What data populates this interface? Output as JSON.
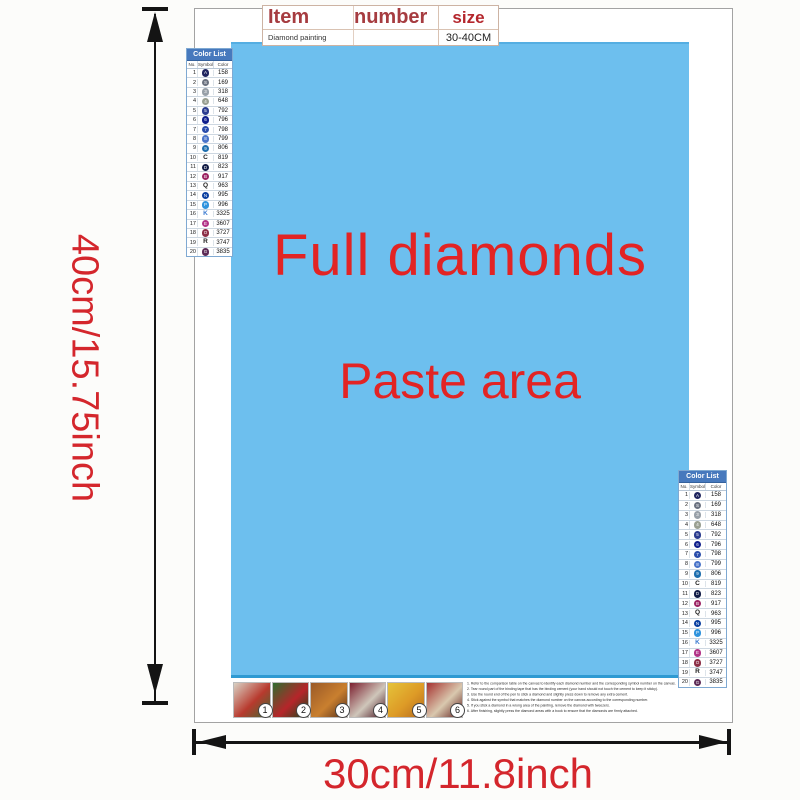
{
  "item_table": {
    "headers": [
      "Item",
      "number",
      "size"
    ],
    "product": "Diamond painting",
    "number_value": "",
    "size": "30-40CM"
  },
  "paste": {
    "line1": "Full diamonds",
    "line2": "Paste area",
    "bg_color": "#6dbfee",
    "text_color": "#e22424"
  },
  "dims": {
    "height": "40cm/15.75inch",
    "width": "30cm/11.8inch"
  },
  "color_list": {
    "title": "Color List",
    "columns": [
      "No.",
      "Symbol",
      "Color"
    ],
    "rows": [
      {
        "no": "1",
        "symbol": "A",
        "circle": "#20255f",
        "code": "158"
      },
      {
        "no": "2",
        "symbol": "S",
        "circle": "#6b7280",
        "code": "169"
      },
      {
        "no": "3",
        "symbol": "3",
        "circle": "#98a0a8",
        "code": "318"
      },
      {
        "no": "4",
        "symbol": "4",
        "circle": "#9aa092",
        "code": "648"
      },
      {
        "no": "5",
        "symbol": "5",
        "circle": "#2b3c8f",
        "code": "792"
      },
      {
        "no": "6",
        "symbol": "6",
        "circle": "#101f8c",
        "code": "796"
      },
      {
        "no": "7",
        "symbol": "7",
        "circle": "#2a4dab",
        "code": "798"
      },
      {
        "no": "8",
        "symbol": "8",
        "circle": "#4a74c9",
        "code": "799"
      },
      {
        "no": "9",
        "symbol": "9",
        "circle": "#1f6fae",
        "code": "806"
      },
      {
        "no": "10",
        "symbol": "C",
        "circle": "",
        "letter_color": "#1c1c1c",
        "code": "819"
      },
      {
        "no": "11",
        "symbol": "D",
        "circle": "#121c46",
        "code": "823"
      },
      {
        "no": "12",
        "symbol": "B",
        "circle": "#9c2363",
        "code": "917"
      },
      {
        "no": "13",
        "symbol": "Q",
        "circle": "",
        "letter_color": "#1c1c1c",
        "code": "963"
      },
      {
        "no": "14",
        "symbol": "N",
        "circle": "#0a3fa0",
        "code": "995"
      },
      {
        "no": "15",
        "symbol": "P",
        "circle": "#2f93dd",
        "code": "996"
      },
      {
        "no": "16",
        "symbol": "K",
        "circle": "",
        "letter_color": "#3a7ad0",
        "code": "3325"
      },
      {
        "no": "17",
        "symbol": "E",
        "circle": "#b23387",
        "code": "3607"
      },
      {
        "no": "18",
        "symbol": "O",
        "circle": "#8c2f47",
        "code": "3727"
      },
      {
        "no": "19",
        "symbol": "R",
        "circle": "",
        "letter_color": "#1c1c1c",
        "code": "3747"
      },
      {
        "no": "20",
        "symbol": "G",
        "circle": "#5c2a56",
        "code": "3835"
      }
    ]
  },
  "steps": [
    {
      "num": "1",
      "colors": [
        "#d9d2c4",
        "#b83a2e",
        "#3e6b31"
      ]
    },
    {
      "num": "2",
      "colors": [
        "#2f6d2f",
        "#b6252a",
        "#184a1c"
      ]
    },
    {
      "num": "3",
      "colors": [
        "#9a5a28",
        "#c97f2f",
        "#54301c"
      ]
    },
    {
      "num": "4",
      "colors": [
        "#7c2030",
        "#cfc6ba",
        "#46121f"
      ]
    },
    {
      "num": "5",
      "colors": [
        "#e5c33a",
        "#dd9a26",
        "#b46a1e"
      ]
    },
    {
      "num": "6",
      "colors": [
        "#a63331",
        "#d9c8ae",
        "#5f1d1d"
      ]
    }
  ],
  "instructions": {
    "lines": [
      "1. Refer to the comparison table on the canvas to identify each diamond number and the corresponding symbol number on the canvas.",
      "2. Tear round part of the binding tape that has the binding cement (your hand should not touch the cement to keep it sticky).",
      "3. Use the round end of the pen to stick a diamond and slightly press down to remove any extra cement.",
      "4. Stick against the symbol that matches the diamond number on the canvas according to the corresponding number.",
      "5. If you stick a diamond in a wrong area of the painting, remove the diamond with tweezers.",
      "6. After finishing, slightly press the diamond areas with a book to ensure that the diamonds are firmly attached."
    ]
  }
}
